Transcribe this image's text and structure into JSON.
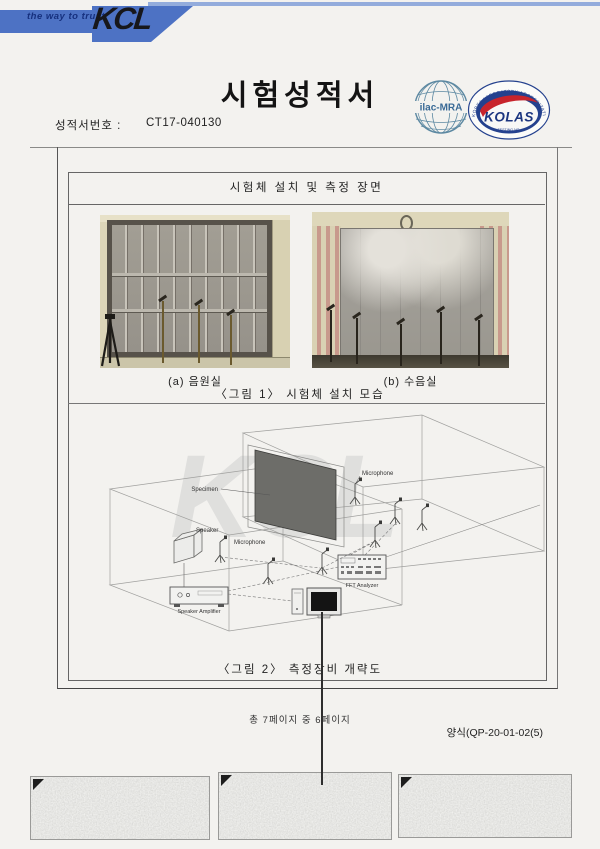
{
  "header": {
    "tagline": "the way to trust",
    "logo_text": "KCL",
    "band_color": "#4d72c4",
    "strip_color": "#93acdc"
  },
  "title": "시험성적서",
  "report": {
    "label": "성적서번호 :",
    "number": "CT17-040130"
  },
  "certifications": {
    "ilac_label": "ilac-MRA",
    "kolas_label": "KOLAS",
    "kolas_arc_text": "KOREA LABORATORY ACCREDITATION SCHEME",
    "kolas_sub_text": "TESTING NO."
  },
  "figure_section": {
    "header": "시험체 설치 및 측정 장면",
    "photo_a_caption": "(a) 음원실",
    "photo_b_caption": "(b) 수음실",
    "figure1_caption": "〈그림 1〉 시험체 설치 모습",
    "figure2_caption": "〈그림 2〉 측정장비 개략도"
  },
  "diagram": {
    "watermark": "KCL",
    "labels": {
      "specimen": "Specimen",
      "microphone": "Microphone",
      "speaker": "Speaker",
      "amplifier": "Speaker Amplifier",
      "fft_analyzer": "FFT Analyzer"
    }
  },
  "footer": {
    "page_info": "총 7페이지 중 6페이지",
    "form_number": "양식(QP-20-01-02(5)"
  }
}
